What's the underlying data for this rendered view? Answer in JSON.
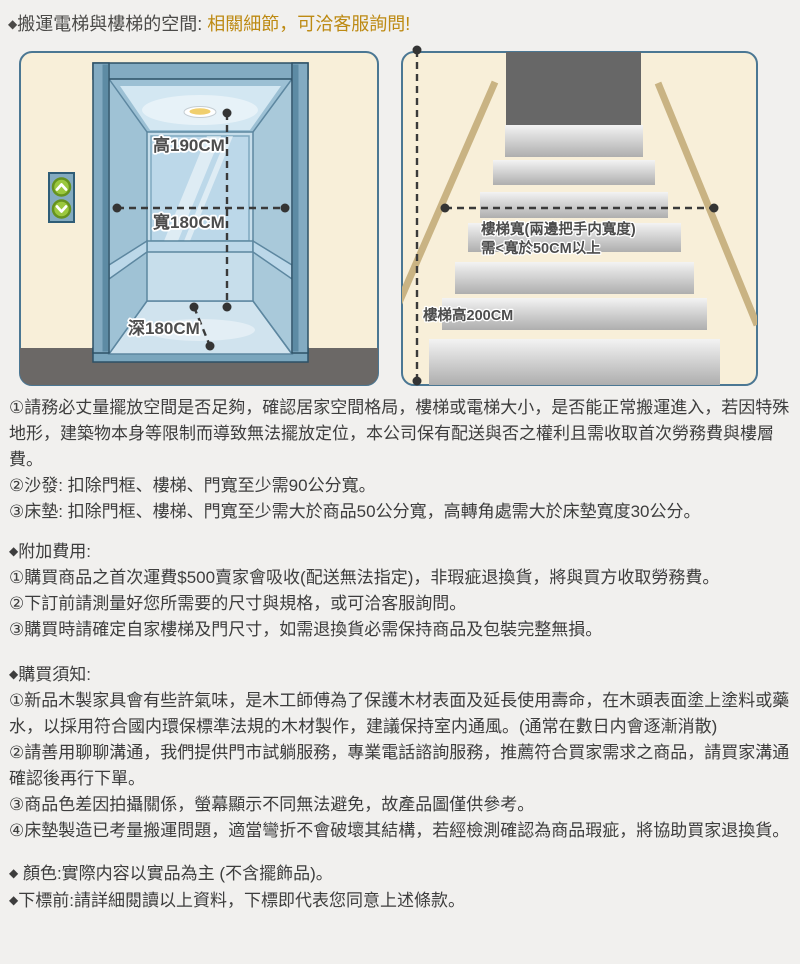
{
  "title": {
    "bullet": "◆",
    "prefix": "搬運電梯與樓梯的空間: ",
    "highlight": "相關細節，可洽客服詢問!"
  },
  "colors": {
    "page_bg": "#f1f0ee",
    "panel_bg": "#f8efd9",
    "panel_border": "#4b7793",
    "title_text": "#4b4a48",
    "title_highlight": "#bd8a13",
    "body_text": "#3d3d3d",
    "floor_gray": "#6b6866",
    "doorway_gray": "#676767",
    "handrail_tan": "#c9b383",
    "elevator_blue": "#83abc2",
    "button_green": "#9bc83f"
  },
  "elevator_diagram": {
    "height_label": "高190CM",
    "width_label": "寬180CM",
    "depth_label": "深180CM"
  },
  "stairs_diagram": {
    "width_note_line1": "樓梯寬(兩邊把手内寬度)",
    "width_note_line2": "需<寬於50CM以上",
    "height_label": "樓梯高200CM"
  },
  "measurement_notes": {
    "items": [
      "①請務必丈量擺放空間是否足夠，確認居家空間格局，樓梯或電梯大小，是否能正常搬運進入，若因特殊地形，建築物本身等限制而導致無法擺放定位，本公司保有配送與否之權利且需收取首次勞務費與樓層費。",
      "②沙發: 扣除門框、樓梯、門寬至少需90公分寬。",
      "③床墊: 扣除門框、樓梯、門寬至少需大於商品50公分寬，高轉角處需大於床墊寬度30公分。"
    ]
  },
  "additional_fees": {
    "bullet": "◆",
    "heading": "附加費用:",
    "items": [
      "①購買商品之首次運費$500賣家會吸收(配送無法指定)，非瑕疵退換貨，將與買方收取勞務費。",
      "②下訂前請測量好您所需要的尺寸與規格，或可洽客服詢問。",
      "③購買時請確定自家樓梯及門尺寸，如需退換貨必需保持商品及包裝完整無損。"
    ]
  },
  "purchase_notes": {
    "bullet": "◆",
    "heading": "購買須知:",
    "items": [
      "①新品木製家具會有些許氣味，是木工師傅為了保護木材表面及延長使用壽命，在木頭表面塗上塗料或藥水，以採用符合國内環保標準法規的木材製作，建議保持室内通風。(通常在數日内會逐漸消散)",
      "②請善用聊聊溝通，我們提供門市試躺服務，專業電話諮詢服務，推薦符合買家需求之商品，請買家溝通確認後再行下單。",
      "③商品色差因拍攝關係，螢幕顯示不同無法避免，故產品圖僅供參考。",
      "④床墊製造已考量搬運問題，適當彎折不會破壞其結構，若經檢測確認為商品瑕疵，將協助買家退換貨。"
    ]
  },
  "footer_notes": {
    "bullet1": "◆",
    "line1": " 顏色:實際内容以實品為主 (不含擺飾品)。",
    "bullet2": "◆",
    "line2": "下標前:請詳細閱讀以上資料，下標即代表您同意上述條款。"
  }
}
